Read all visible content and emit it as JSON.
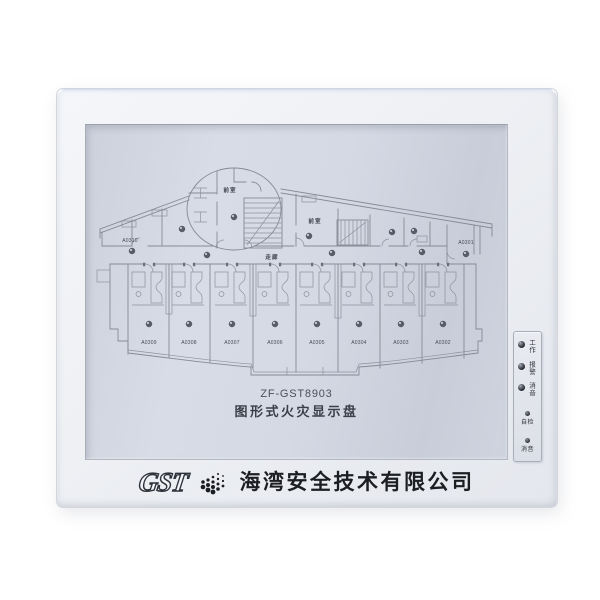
{
  "device": {
    "model": "ZF-GST8903",
    "product_name": "图形式火灾显示盘"
  },
  "display": {
    "plan": {
      "corridor_label": "走廊",
      "vestibule_label": "前室",
      "left_end_room": "A0310",
      "right_end_room": "A0301",
      "lower_rooms": [
        "A0309",
        "A0308",
        "A0307",
        "A0306",
        "A0305",
        "A0304",
        "A0303",
        "A0302"
      ]
    }
  },
  "indicator_strip": {
    "leds": [
      {
        "label": "工作"
      },
      {
        "label": "报警"
      },
      {
        "label": "消音"
      }
    ],
    "buttons": [
      {
        "label": "自检"
      },
      {
        "label": "消音"
      }
    ]
  },
  "footer": {
    "logo_text": "GST",
    "company_name": "海湾安全技术有限公司"
  },
  "colors": {
    "panel_face": "#eef0f4",
    "display_surface": "#d2d7e1",
    "plan_line": "#858b96",
    "led_off": "#23262c",
    "text_dark": "#3a3f48"
  }
}
